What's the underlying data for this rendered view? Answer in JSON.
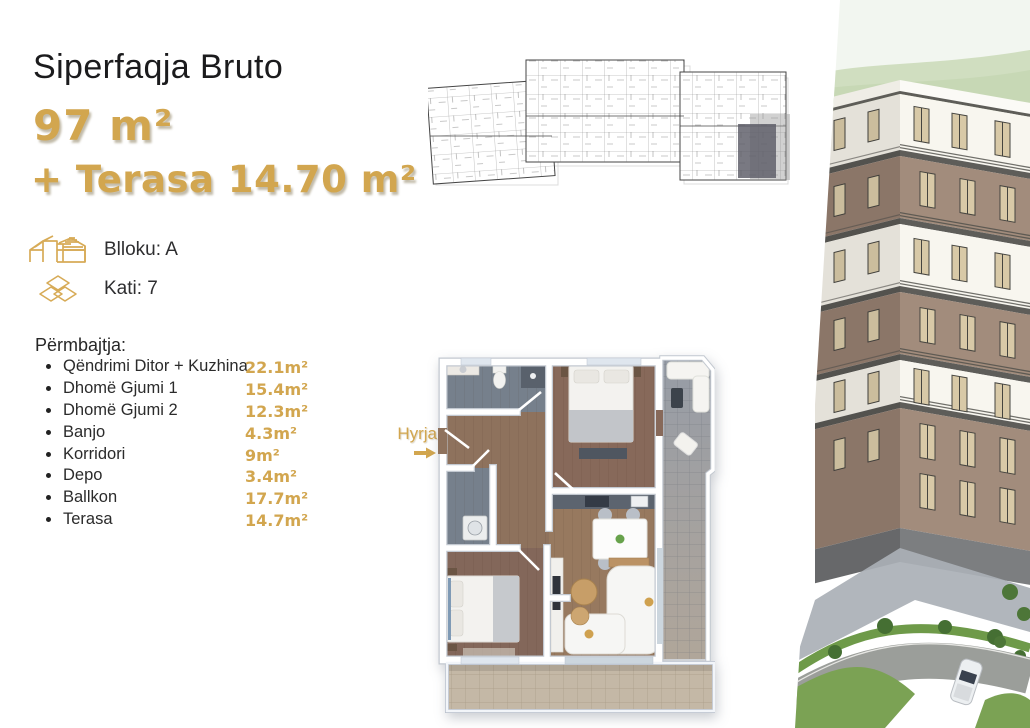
{
  "header": {
    "title": "Siperfaqja Bruto",
    "gross_area": "97 m²",
    "terrace_area": "+ Terasa 14.70 m²"
  },
  "meta": {
    "block": "Blloku: A",
    "floor": "Kati: 7"
  },
  "contents": {
    "heading": "Përmbajtja:",
    "items": [
      {
        "label": "Qëndrimi Ditor + Kuzhina",
        "value": "22.1m²"
      },
      {
        "label": "Dhomë Gjumi 1",
        "value": "15.4m²"
      },
      {
        "label": "Dhomë Gjumi 2",
        "value": "12.3m²"
      },
      {
        "label": "Banjo",
        "value": "4.3m²"
      },
      {
        "label": "Korridori",
        "value": "9m²"
      },
      {
        "label": "Depo",
        "value": "3.4m²"
      },
      {
        "label": "Ballkon",
        "value": "17.7m²"
      },
      {
        "label": "Terasa",
        "value": "14.7m²"
      }
    ]
  },
  "floorplan": {
    "entrance_label": "Hyrja"
  },
  "icons": {
    "block_icon": "building-blocks-outline",
    "floor_icon": "stacked-floor-tiles",
    "entrance_arrow_icon": "arrow-right"
  },
  "colors": {
    "accent_gold": "#d2a64f",
    "text_dark": "#1b1b1d",
    "highlighted_unit": "#5c5c66"
  }
}
